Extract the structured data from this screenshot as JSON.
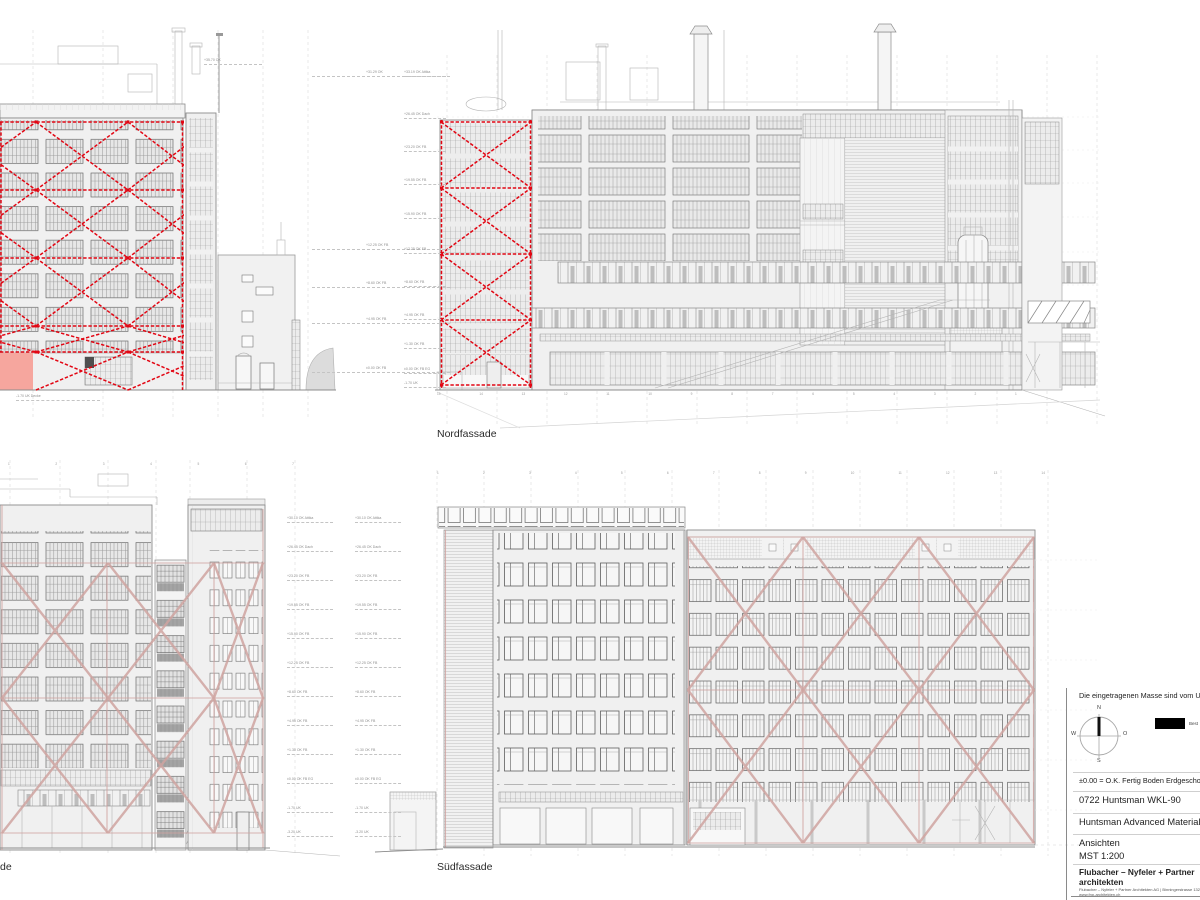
{
  "colors": {
    "red": "#e20613",
    "pink": "#cfa3a0",
    "salmon": "#f6a69e"
  },
  "labels": {
    "north": "Nordfassade",
    "south": "Südfassade",
    "west_fragment": "de"
  },
  "titleblock": {
    "note": "Die eingetragenen Masse sind vom Un",
    "legend_label": "Best",
    "datum": "±0.00 = O.K. Fertig Boden Erdgeschos",
    "project": "0722 Huntsman WKL-90",
    "client": "Huntsman Advanced Materials Gr",
    "sheet": "Ansichten",
    "scale": "MST 1:200",
    "firm_line1": "Flubacher – Nyfeler + Partner",
    "firm_line2": "architekten",
    "firm_address": "Flubacher – Nyfeler + Partner Architekten AG | Binningerstrasse 132 | 4",
    "firm_web": "www.fnp-architekten.ch",
    "compass": {
      "n": "N",
      "e": "O",
      "s": "S",
      "w": "W"
    }
  },
  "levels": {
    "topA": [
      "+35.70 OK"
    ],
    "topB": [
      "+31.29 OK",
      "+12.25 OK FB",
      "+8.60 OK FB",
      "+4.95 OK FB",
      "±0.00 OK FB"
    ],
    "topC": [
      "+33.19 OK Attika",
      "+26.45 OK Dach",
      "+23.20 OK FB",
      "+19.55 OK FB",
      "+15.90 OK FB",
      "+12.25 OK FB",
      "+8.60 OK FB",
      "+4.95 OK FB",
      "+1.30 OK FB",
      "±0.00 OK FB EG",
      "-1.70 UK"
    ],
    "botD": [
      "+30.10 OK Attika",
      "+26.45 OK Dach",
      "+23.20 OK FB",
      "+19.55 OK FB",
      "+15.90 OK FB",
      "+12.25 OK FB",
      "+8.60 OK FB",
      "+4.95 OK FB",
      "+1.30 OK FB",
      "±0.00 OK FB EG",
      "-1.70 UK",
      "-3.20 UK"
    ],
    "botE": [
      "+30.10 OK Attika",
      "+26.45 OK Dach",
      "+23.20 OK FB",
      "+19.55 OK FB",
      "+15.90 OK FB",
      "+12.25 OK FB",
      "+8.60 OK FB",
      "+4.95 OK FB",
      "+1.30 OK FB",
      "±0.00 OK FB EG",
      "-1.70 UK",
      "-3.20 UK"
    ],
    "under": [
      "-1.70 UK Decke"
    ]
  },
  "ticks": {
    "north": [
      "15",
      "14",
      "13",
      "12",
      "11",
      "10",
      "9",
      "8",
      "7",
      "6",
      "5",
      "4",
      "3",
      "2",
      "1"
    ],
    "south": [
      "1",
      "2",
      "3",
      "4",
      "5",
      "6",
      "7",
      "8",
      "9",
      "10",
      "11",
      "12",
      "13",
      "14"
    ],
    "bottom_left": [
      "1",
      "2",
      "3",
      "4",
      "5",
      "6",
      "7"
    ]
  }
}
